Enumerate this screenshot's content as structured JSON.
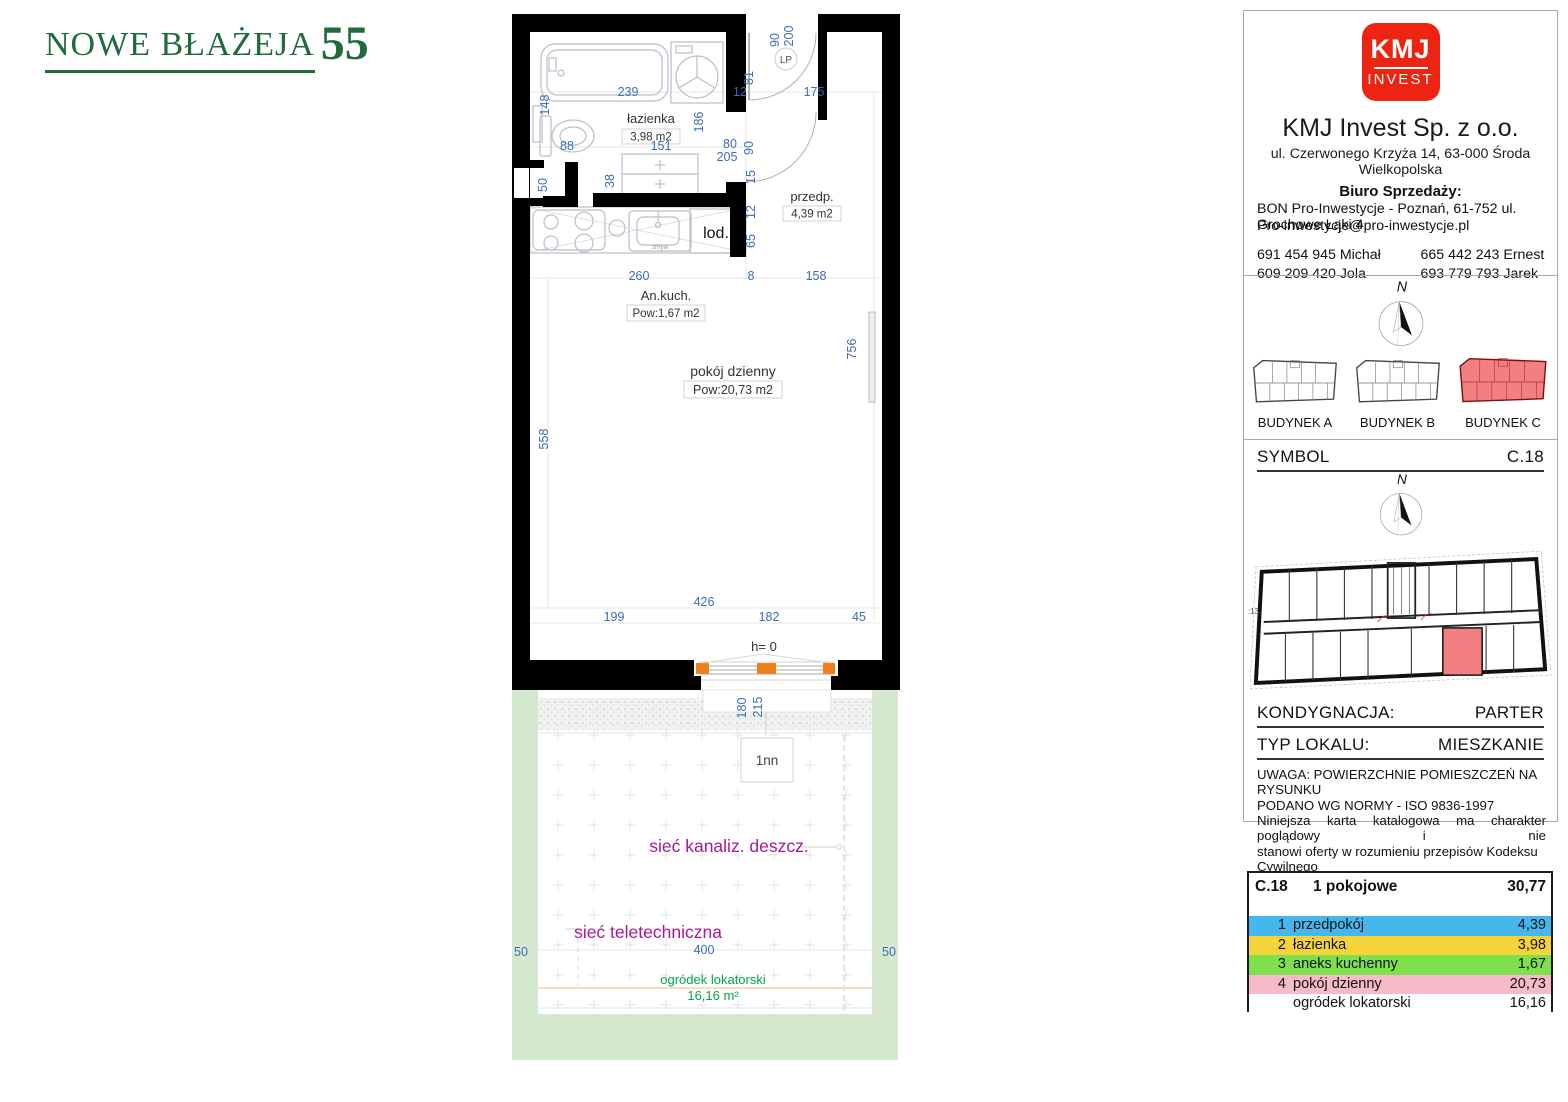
{
  "colors": {
    "brand_green": "#1f6b3a",
    "brand_red": "#ee2413",
    "dim_blue": "#3a6db8",
    "utility_magenta": "#a81896",
    "garden_green": "#d3e8cc",
    "garden_text_green": "#00a550",
    "unit_red": "#f28080",
    "window_accent": "#f08019",
    "row_blue": "#44b7ef",
    "row_yellow": "#f5d339",
    "row_green": "#7fe04e",
    "row_pink": "#f6bac8",
    "row_white": "#ffffff"
  },
  "brand": {
    "title": "NOWE BŁAŻEJA",
    "number": "55"
  },
  "company": {
    "logo_top": "KMJ",
    "logo_bottom": "INVEST",
    "name": "KMJ Invest Sp. z o.o.",
    "address": "ul. Czerwonego Krzyża 14, 63-000 Środa Wielkopolska",
    "sales_label": "Biuro Sprzedaży:",
    "sales_line": "BON Pro-Inwestycje - Poznań, 61-752 ul. Grochowe Łąki 4",
    "sales_email": "Pro-inwestycje@pro-inwestycje.pl",
    "phones": [
      "691 454 945 Michał",
      "609 209 420 Jola",
      "665 442 243 Ernest",
      "693 779 793 Jarek"
    ]
  },
  "buildings": {
    "a": "BUDYNEK A",
    "b": "BUDYNEK B",
    "c": "BUDYNEK C"
  },
  "unit": {
    "symbol_label": "SYMBOL",
    "symbol": "C.18",
    "floor_label": "KONDYGNACJA:",
    "floor": "PARTER",
    "type_label": "TYP LOKALU:",
    "type": "MIESZKANIE",
    "north": "N",
    "note1": "UWAGA: POWIERZCHNIE POMIESZCZEŃ NA RYSUNKU",
    "note2": "PODANO WG NORMY - ISO 9836-1997",
    "note3": "Niniejsza karta katalogowa ma charakter poglądowy i nie",
    "note4": "stanowi oferty w rozumieniu przepisów Kodeksu Cywilnego",
    "plan_scale": ":13"
  },
  "area_table": {
    "symbol": "C.18",
    "type": "1 pokojowe",
    "total": "30,77",
    "rows": [
      {
        "num": "1",
        "name": "przedpokój",
        "area": "4,39",
        "color": "#44b7ef"
      },
      {
        "num": "2",
        "name": "łazienka",
        "area": "3,98",
        "color": "#f5d339"
      },
      {
        "num": "3",
        "name": "aneks kuchenny",
        "area": "1,67",
        "color": "#7fe04e"
      },
      {
        "num": "4",
        "name": "pokój dzienny",
        "area": "20,73",
        "color": "#f6bac8"
      },
      {
        "num": "",
        "name": "ogródek lokatorski",
        "area": "16,16",
        "color": "#ffffff"
      }
    ]
  },
  "plan": {
    "rooms": {
      "bathroom": {
        "name": "łazienka",
        "area": "3,98 m2"
      },
      "hall": {
        "name": "przedp.",
        "area": "4,39 m2"
      },
      "kitchen": {
        "name": "An.kuch.",
        "area": "Pow:1,67 m2"
      },
      "living": {
        "name": "pokój dzienny",
        "area": "Pow:20,73 m2"
      }
    },
    "labels": {
      "fridge": "lod.",
      "sink": "zmyw",
      "entry": "LP",
      "window_h": "h= 0",
      "garden_marker": "1nn",
      "storm_sewer": "sieć kanaliz. deszcz.",
      "telecom": "sieć teletechniczna",
      "garden_name": "ogródek lokatorski",
      "garden_area": "16,16 m²"
    },
    "dims": {
      "door_w": "90",
      "door_h": "200",
      "d81": "81",
      "d12_top": "12",
      "d175": "175",
      "d239": "239",
      "d148": "148",
      "d88": "88",
      "d151": "151",
      "d186": "186",
      "bath_door_w": "80",
      "bath_door_h": "205",
      "d90b": "90",
      "d50": "50",
      "d38": "38",
      "d15": "15",
      "d12k": "12",
      "d65": "65",
      "d260": "260",
      "d8": "8",
      "d158": "158",
      "d756": "756",
      "d558": "558",
      "d426": "426",
      "d199": "199",
      "d182": "182",
      "d45": "45",
      "d180": "180",
      "d215": "215",
      "g50l": "50",
      "g400": "400",
      "g50r": "50"
    }
  }
}
